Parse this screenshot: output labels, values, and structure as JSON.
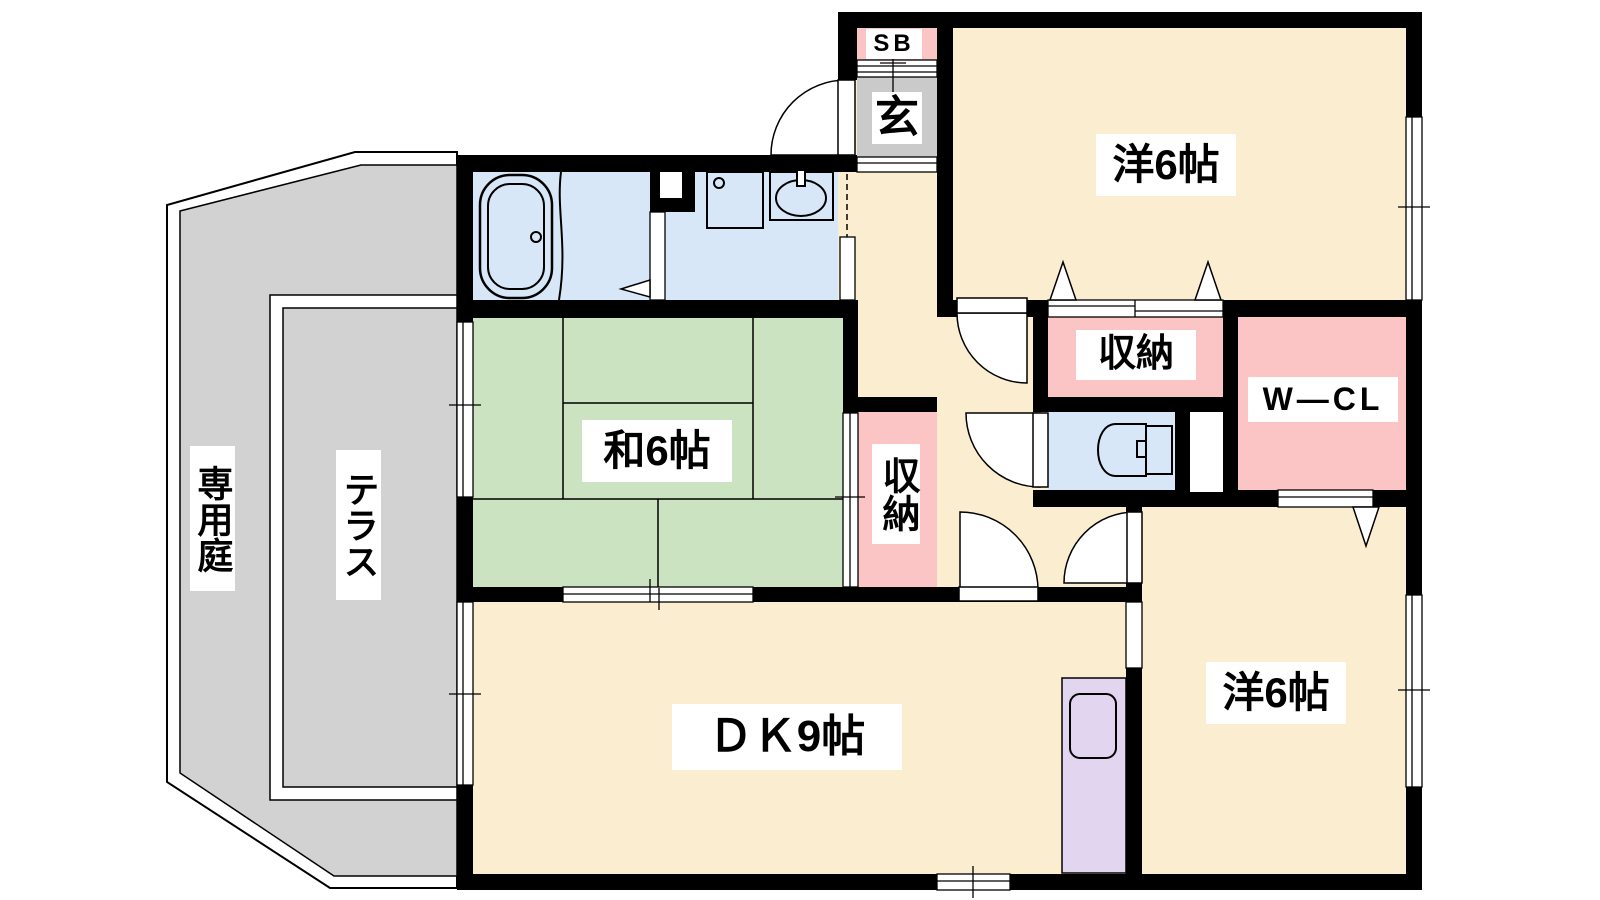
{
  "floorplan": {
    "type": "apartment-floor-plan",
    "labels": {
      "garden": "専用庭",
      "terrace": "テラス",
      "shoe_box": "SB",
      "entrance": "玄",
      "western_room_top": "洋6帖",
      "western_room_bottom": "洋6帖",
      "japanese_room": "和6帖",
      "dining_kitchen": "ＤＫ9帖",
      "storage_hall": "収納",
      "storage_tatami": "収納",
      "walk_in_closet": "W—CL"
    },
    "colors": {
      "wall": "#000000",
      "room_cream": "#fbeed0",
      "tatami_green": "#cbe3c0",
      "water_blue": "#d7e7f7",
      "closet_pink": "#fbc5c6",
      "entrance_gray": "#cacaca",
      "outdoor_gray": "#d2d2d2",
      "kitchen_purple": "#e2d5ef"
    }
  }
}
